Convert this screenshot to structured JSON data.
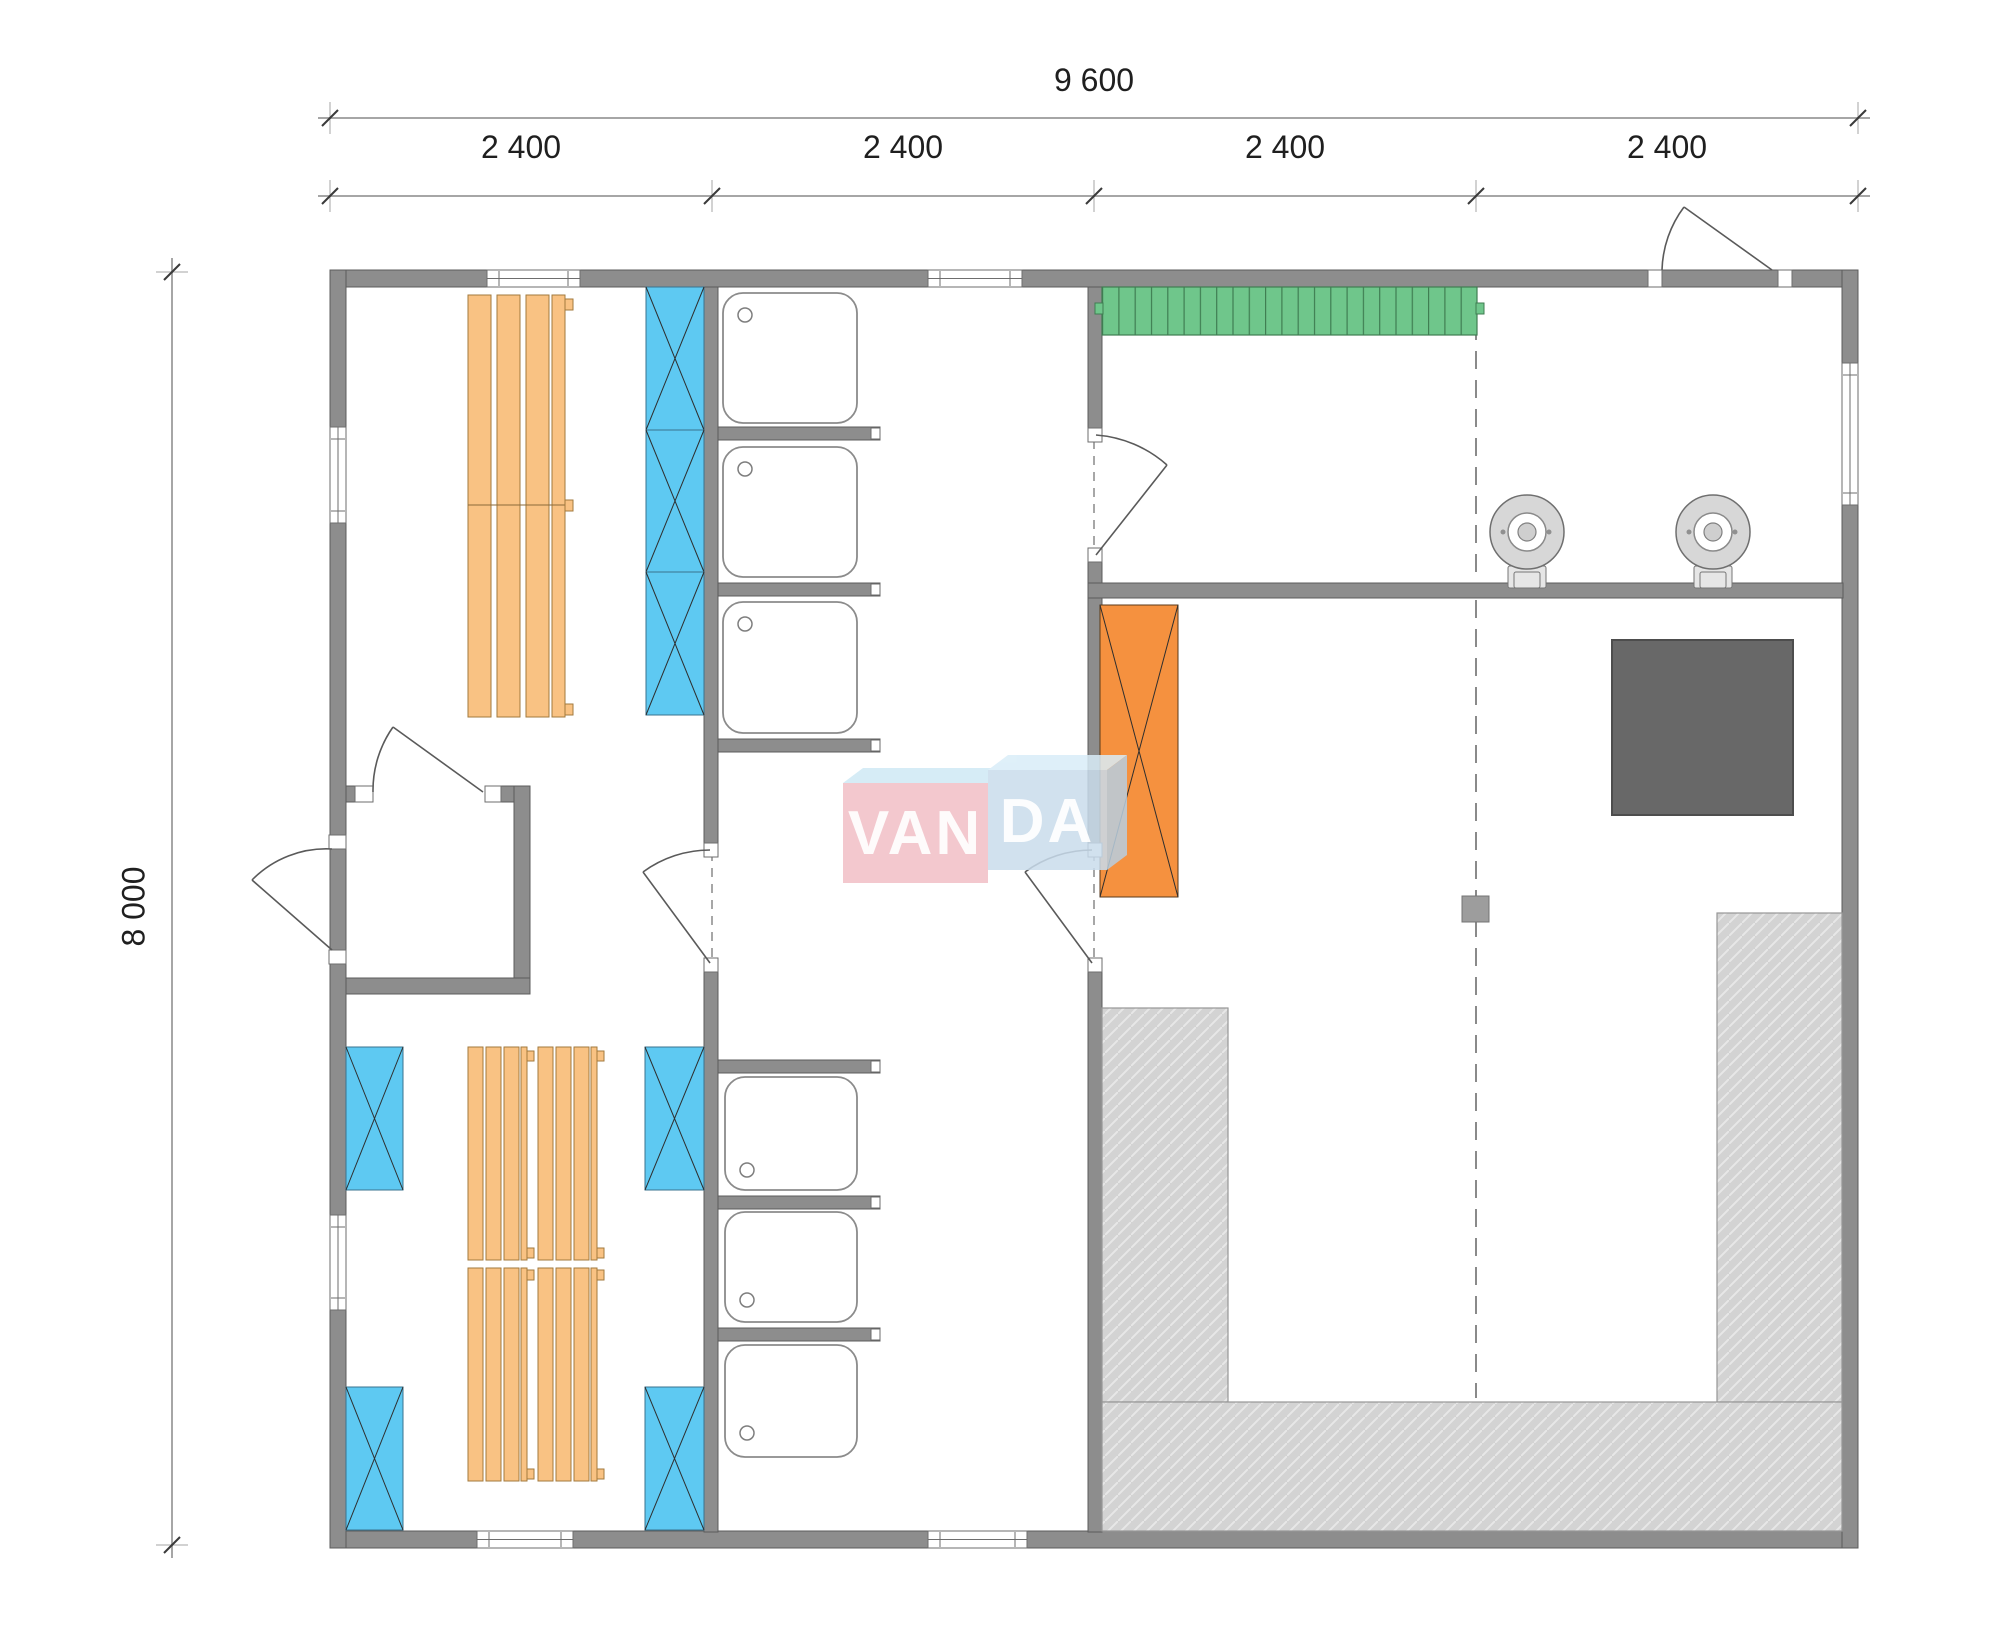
{
  "page": {
    "type": "architectural floor plan drawing",
    "background": "#ffffff"
  },
  "dimensions": {
    "overall_width": "9 600",
    "overall_depth": "8 000",
    "bays": [
      "2 400",
      "2 400",
      "2 400",
      "2 400"
    ]
  },
  "watermark": {
    "full": "VANDA",
    "text_left": "VAN",
    "text_right": "DA"
  },
  "colors": {
    "wall": "#8d8d8d",
    "blue_panel": "#5ec9f2",
    "bench_orange": "#f9c283",
    "green_bench": "#6fc68b",
    "heater_orange": "#f5913f",
    "platform": "#d3d3d3",
    "stove": "#686868",
    "watermark_pink": "#f2bfc6",
    "watermark_blue": "#c9dcec"
  },
  "fixture_counts": {
    "shower_trays": 6,
    "blue_hatched_panels": 7,
    "wood_benches": 5,
    "round_wall_units": 2,
    "doors": 6,
    "windows": 7
  }
}
